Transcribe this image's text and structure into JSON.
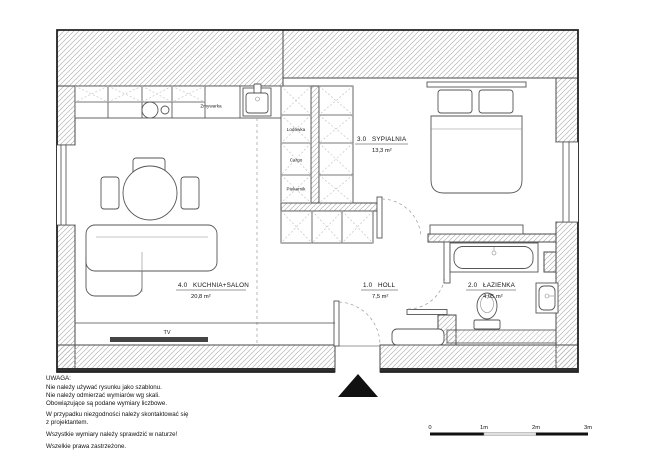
{
  "rooms": {
    "kitchen_salon": {
      "number": "4.0",
      "name": "KUCHNIA+SALON",
      "area": "20,8 m²"
    },
    "bedroom": {
      "number": "3.0",
      "name": "SYPIALNIA",
      "area": "13,3 m²"
    },
    "hall": {
      "number": "1.0",
      "name": "HOLL",
      "area": "7,5 m²"
    },
    "bathroom": {
      "number": "2.0",
      "name": "ŁAZIENKA",
      "area": "4,05 m²"
    }
  },
  "labels": {
    "dishwasher": "Zmywarka",
    "fridge": "Lodówka",
    "cargo": "Cargo",
    "oven": "Piekarnik",
    "tv": "TV"
  },
  "notes": {
    "title": "UWAGA:",
    "lines": [
      "Nie należy używać rysunku jako szablonu.",
      "Nie należy odmierzać wymiarów wg skali.",
      "Obowiązujące są podane wymiary liczbowe.",
      "W przypadku niezgodności należy skontaktować się",
      "z projektantem.",
      "Wszystkie wymiary należy sprawdzić w naturze!",
      "Wszelkie prawa zastrzeżone."
    ]
  },
  "scale_bar": {
    "t0": "0",
    "t1": "1m",
    "t2": "2m",
    "t3": "3m"
  },
  "colors": {
    "line": "#4a4a4a",
    "hatch": "#b5b5b5",
    "dark": "#111111",
    "tv_bar": "#444444",
    "scale_light": "#e0e0e0"
  }
}
